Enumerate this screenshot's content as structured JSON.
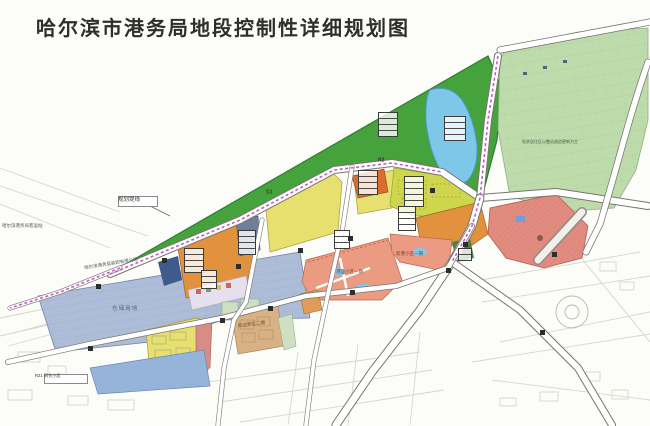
{
  "title": "哈尔滨市港务局地段控制性详细规划图",
  "map": {
    "labels": {
      "dike_line": "规划堤线",
      "zone_code_green": "G1",
      "zone_code_r2": "R2",
      "passenger_center": "哈尔滨港务局客运站",
      "port_company": "哈尔滨港务局装卸有限公司",
      "storage_area": "仓储用地",
      "district_one": "港运小区一期",
      "district_two": "新港小区一期",
      "new_area_phase2": "航运新区二期",
      "existing_note": "现状居住区以整治改造更新为主",
      "r21_chip": "R21 码头小区"
    },
    "colors": {
      "paper": "#fcfcf9",
      "green": "#46a23c",
      "green_edge": "#2e7d32",
      "light_green": "#bedcab",
      "lake": "#7fc7e8",
      "lake_edge": "#4a9cc9",
      "orange": "#e2913c",
      "red_orange": "#d96d2e",
      "chartreuse": "#cdd64d",
      "yellow": "#e7df6e",
      "salmon": "#eb9b82",
      "red_zone": "#e28b80",
      "port_blue": "#adbdd8",
      "blue_block": "#96b3d9",
      "tan": "#d8b184",
      "pink_strip": "#d98c85",
      "pale_strip": "#e6dfee",
      "pale_green": "#cfe0c2",
      "dark_navy": "#3f5a8c",
      "dark_green": "#4e7e46",
      "magenta": "#c35cc3",
      "road_edge": "#77756f",
      "faint_line": "#d8d4ca"
    }
  }
}
